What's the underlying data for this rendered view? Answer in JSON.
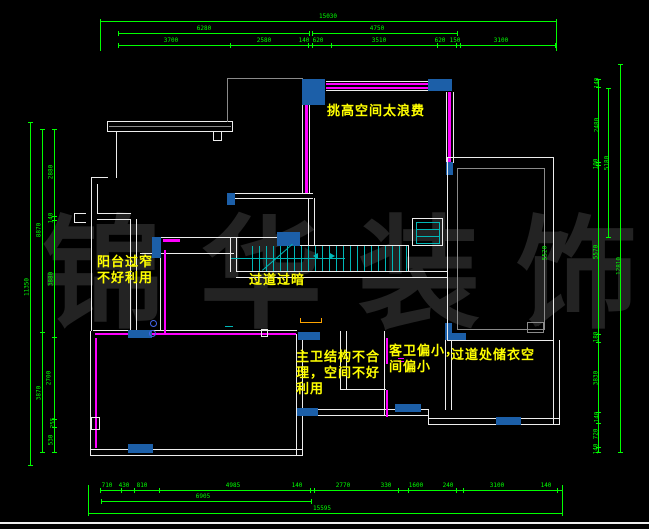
{
  "watermark": {
    "text": "锦华装饰"
  },
  "colors": {
    "background": "#000000",
    "wall": "#ededed",
    "wall_inner": "#8a8a8a",
    "dimension": "#00ff00",
    "highlight_wall": "#ff00ff",
    "window_fill": "#1c5fa8",
    "stair": "#00b7b7",
    "annotation": "#ffff00",
    "watermark": "#232323",
    "marker": "#ffa500",
    "symbol_blue": "#4466ee"
  },
  "annotations": [
    {
      "id": "double-height-note",
      "x": 327,
      "y": 104,
      "lines": [
        "挑高空间太浪费"
      ]
    },
    {
      "id": "balcony-note",
      "x": 97,
      "y": 255,
      "lines": [
        "阳台过窄",
        "不好利用"
      ]
    },
    {
      "id": "corridor-dark-note",
      "x": 249,
      "y": 273,
      "lines": [
        "过道过暗"
      ]
    },
    {
      "id": "master-bath-note",
      "x": 296,
      "y": 350,
      "lines": [
        "主卫结构不合",
        "理，空间不好",
        "利用"
      ]
    },
    {
      "id": "guest-bath-note",
      "x": 389,
      "y": 344,
      "lines": [
        "客卫偏小，",
        "间偏小"
      ]
    },
    {
      "id": "closet-note",
      "x": 451,
      "y": 348,
      "lines": [
        "过道处储衣空"
      ]
    }
  ],
  "dimensions": {
    "top": [
      {
        "t": "15030",
        "x": 328,
        "y": 13
      },
      {
        "t": "6280",
        "x": 204,
        "y": 25
      },
      {
        "t": "4750",
        "x": 377,
        "y": 25
      },
      {
        "t": "3700",
        "x": 171,
        "y": 37
      },
      {
        "t": "2580",
        "x": 264,
        "y": 37
      },
      {
        "t": "140",
        "x": 304,
        "y": 37
      },
      {
        "t": "620",
        "x": 318,
        "y": 37
      },
      {
        "t": "3510",
        "x": 379,
        "y": 37
      },
      {
        "t": "620",
        "x": 440,
        "y": 37
      },
      {
        "t": "150",
        "x": 455,
        "y": 37
      },
      {
        "t": "3100",
        "x": 501,
        "y": 37
      }
    ],
    "bottom": [
      {
        "t": "710",
        "x": 107,
        "y": 482
      },
      {
        "t": "430",
        "x": 124,
        "y": 482
      },
      {
        "t": "810",
        "x": 142,
        "y": 482
      },
      {
        "t": "4985",
        "x": 233,
        "y": 482
      },
      {
        "t": "140",
        "x": 297,
        "y": 482
      },
      {
        "t": "2770",
        "x": 343,
        "y": 482
      },
      {
        "t": "330",
        "x": 386,
        "y": 482
      },
      {
        "t": "1600",
        "x": 416,
        "y": 482
      },
      {
        "t": "240",
        "x": 448,
        "y": 482
      },
      {
        "t": "3100",
        "x": 497,
        "y": 482
      },
      {
        "t": "140",
        "x": 546,
        "y": 482
      },
      {
        "t": "6905",
        "x": 203,
        "y": 493
      },
      {
        "t": "15595",
        "x": 322,
        "y": 505
      }
    ],
    "left": [
      {
        "t": "11350",
        "x": 27,
        "y": 287
      },
      {
        "t": "8870",
        "x": 39,
        "y": 230
      },
      {
        "t": "3870",
        "x": 39,
        "y": 393
      },
      {
        "t": "2880",
        "x": 51,
        "y": 172
      },
      {
        "t": "140",
        "x": 51,
        "y": 218
      },
      {
        "t": "3880",
        "x": 51,
        "y": 279
      },
      {
        "t": "2700",
        "x": 49,
        "y": 378
      },
      {
        "t": "255",
        "x": 53,
        "y": 423
      },
      {
        "t": "530",
        "x": 51,
        "y": 440
      }
    ],
    "right": [
      {
        "t": "140",
        "x": 597,
        "y": 83
      },
      {
        "t": "2480",
        "x": 597,
        "y": 125
      },
      {
        "t": "100",
        "x": 596,
        "y": 164
      },
      {
        "t": "5570",
        "x": 596,
        "y": 252
      },
      {
        "t": "180",
        "x": 596,
        "y": 337
      },
      {
        "t": "3830",
        "x": 596,
        "y": 378
      },
      {
        "t": "140",
        "x": 597,
        "y": 417
      },
      {
        "t": "720",
        "x": 596,
        "y": 434
      },
      {
        "t": "140",
        "x": 596,
        "y": 449
      },
      {
        "t": "5180",
        "x": 607,
        "y": 163
      },
      {
        "t": "12810",
        "x": 619,
        "y": 266
      },
      {
        "t": "5520",
        "x": 545,
        "y": 253
      }
    ]
  },
  "geometry": {
    "white": [
      [
        107,
        121,
        126,
        1
      ],
      [
        107,
        131,
        126,
        1
      ],
      [
        232,
        121,
        1,
        11
      ],
      [
        107,
        121,
        1,
        11
      ],
      [
        116,
        131,
        1,
        47
      ],
      [
        91,
        177,
        17,
        1
      ],
      [
        91,
        177,
        1,
        154
      ],
      [
        97,
        184,
        1,
        30
      ],
      [
        97,
        213,
        34,
        1
      ],
      [
        97,
        219,
        33,
        1
      ],
      [
        130,
        219,
        1,
        112
      ],
      [
        136,
        219,
        1,
        112
      ],
      [
        140,
        253,
        94,
        1
      ],
      [
        160,
        246,
        1,
        85
      ],
      [
        161,
        237,
        117,
        1
      ],
      [
        230,
        237,
        1,
        35
      ],
      [
        236,
        237,
        1,
        35
      ],
      [
        236,
        271,
        211,
        1
      ],
      [
        236,
        277,
        211,
        1
      ],
      [
        300,
        245,
        109,
        1
      ],
      [
        408,
        245,
        1,
        27
      ],
      [
        227,
        193,
        86,
        1
      ],
      [
        227,
        198,
        86,
        1
      ],
      [
        308,
        198,
        1,
        48
      ],
      [
        314,
        198,
        1,
        48
      ],
      [
        302,
        105,
        1,
        89
      ],
      [
        309,
        105,
        1,
        89
      ],
      [
        326,
        81,
        103,
        1
      ],
      [
        326,
        90,
        103,
        1
      ],
      [
        446,
        92,
        1,
        71
      ],
      [
        453,
        92,
        1,
        71
      ],
      [
        93,
        330,
        204,
        1
      ],
      [
        90,
        331,
        1,
        124
      ],
      [
        90,
        449,
        213,
        1
      ],
      [
        90,
        455,
        213,
        1
      ],
      [
        296,
        334,
        1,
        121
      ],
      [
        302,
        334,
        1,
        121
      ],
      [
        340,
        331,
        1,
        59
      ],
      [
        346,
        331,
        1,
        59
      ],
      [
        340,
        389,
        46,
        1
      ],
      [
        384,
        331,
        1,
        85
      ],
      [
        297,
        409,
        132,
        1
      ],
      [
        297,
        415,
        132,
        1
      ],
      [
        445,
        340,
        1,
        70
      ],
      [
        451,
        340,
        1,
        70
      ],
      [
        428,
        409,
        1,
        16
      ],
      [
        428,
        418,
        132,
        1
      ],
      [
        428,
        424,
        132,
        1
      ],
      [
        553,
        340,
        1,
        85
      ],
      [
        559,
        340,
        1,
        85
      ],
      [
        74,
        213,
        12,
        1
      ],
      [
        74,
        222,
        12,
        1
      ],
      [
        74,
        213,
        1,
        10
      ],
      [
        0,
        522,
        649,
        2
      ]
    ],
    "gray": [
      [
        109,
        126,
        122,
        1
      ],
      [
        227,
        78,
        1,
        44
      ],
      [
        227,
        78,
        76,
        1
      ]
    ],
    "magenta": [
      [
        326,
        83,
        102,
        2
      ],
      [
        326,
        87,
        102,
        2
      ],
      [
        448,
        92,
        3,
        70
      ],
      [
        305,
        105,
        3,
        88
      ],
      [
        163,
        239,
        17,
        3
      ],
      [
        164,
        250,
        2,
        84
      ],
      [
        95,
        333,
        201,
        2
      ],
      [
        95,
        338,
        2,
        110
      ],
      [
        386,
        338,
        2,
        26
      ],
      [
        386,
        390,
        2,
        27
      ],
      [
        398,
        358,
        6,
        1
      ],
      [
        398,
        361,
        6,
        1
      ]
    ],
    "cyan": [
      [
        231,
        258,
        114,
        1
      ],
      [
        416,
        229,
        24,
        1
      ],
      [
        416,
        236,
        24,
        1
      ],
      [
        225,
        326,
        8,
        1
      ]
    ],
    "orange": [
      [
        300,
        322,
        22,
        1
      ],
      [
        300,
        318,
        1,
        5
      ],
      [
        321,
        318,
        1,
        5
      ]
    ],
    "green": [
      [
        100,
        21,
        456,
        1
      ],
      [
        118,
        33,
        191,
        1
      ],
      [
        312,
        33,
        145,
        1
      ],
      [
        118,
        45,
        437,
        1
      ],
      [
        100,
        490,
        462,
        1
      ],
      [
        101,
        501,
        210,
        1
      ],
      [
        88,
        513,
        474,
        1
      ],
      [
        30,
        122,
        1,
        344
      ],
      [
        42,
        129,
        1,
        324
      ],
      [
        54,
        129,
        1,
        324
      ],
      [
        598,
        79,
        1,
        374
      ],
      [
        608,
        88,
        1,
        150
      ],
      [
        620,
        64,
        1,
        389
      ],
      [
        100,
        21,
        1,
        30
      ],
      [
        556,
        21,
        1,
        30
      ],
      [
        88,
        485,
        1,
        29
      ],
      [
        562,
        485,
        1,
        29
      ]
    ],
    "blue_blocks": [
      [
        302,
        79,
        23,
        26
      ],
      [
        428,
        79,
        24,
        12
      ],
      [
        446,
        162,
        7,
        13
      ],
      [
        227,
        193,
        8,
        12
      ],
      [
        152,
        237,
        9,
        21
      ],
      [
        277,
        232,
        23,
        14
      ],
      [
        128,
        330,
        24,
        8
      ],
      [
        298,
        332,
        22,
        8
      ],
      [
        128,
        444,
        25,
        9
      ],
      [
        297,
        408,
        21,
        8
      ],
      [
        395,
        404,
        26,
        8
      ],
      [
        445,
        323,
        7,
        17
      ],
      [
        445,
        333,
        21,
        7
      ],
      [
        496,
        417,
        25,
        8
      ]
    ],
    "boxes": {
      "white": [
        [
          213,
          131,
          9,
          10
        ],
        [
          447,
          157,
          107,
          184
        ],
        [
          91,
          417,
          9,
          13
        ],
        [
          412,
          218,
          31,
          28
        ],
        [
          261,
          329,
          7,
          8
        ]
      ],
      "gray": [
        [
          457,
          168,
          88,
          162
        ],
        [
          527,
          322,
          17,
          11
        ]
      ],
      "cyan": [
        [
          416,
          222,
          24,
          22
        ]
      ]
    },
    "treads": {
      "x0": 252,
      "x1": 408,
      "step": 7,
      "y": 246,
      "h": 25
    },
    "diagonal": {
      "x": 262,
      "y": 270,
      "len": 40,
      "ang": -41
    },
    "arrows": [
      {
        "x": 313,
        "y": 253,
        "dir": "left"
      },
      {
        "x": 330,
        "y": 253,
        "dir": "right"
      }
    ],
    "circles": [
      [
        150,
        320
      ],
      [
        149,
        330
      ]
    ],
    "hticks": [
      {
        "y": 21,
        "xs": [
          100,
          556
        ]
      },
      {
        "y": 33,
        "xs": [
          118,
          309,
          312,
          457
        ]
      },
      {
        "y": 45,
        "xs": [
          118,
          230,
          308,
          312,
          331,
          437,
          456,
          460,
          555
        ]
      },
      {
        "y": 490,
        "xs": [
          100,
          121,
          134,
          159,
          310,
          314,
          398,
          408,
          456,
          463,
          557,
          562
        ]
      },
      {
        "y": 501,
        "xs": [
          101,
          311
        ]
      },
      {
        "y": 513,
        "xs": [
          88,
          562
        ]
      }
    ],
    "vticks": [
      {
        "x": 30,
        "ys": [
          122,
          465
        ]
      },
      {
        "x": 42,
        "ys": [
          129,
          332,
          452
        ]
      },
      {
        "x": 54,
        "ys": [
          129,
          216,
          220,
          337,
          419,
          427,
          452
        ]
      },
      {
        "x": 598,
        "ys": [
          79,
          87,
          162,
          165,
          334,
          342,
          412,
          423,
          447,
          452
        ]
      },
      {
        "x": 608,
        "ys": [
          88,
          237
        ]
      },
      {
        "x": 620,
        "ys": [
          64,
          452
        ]
      }
    ]
  }
}
